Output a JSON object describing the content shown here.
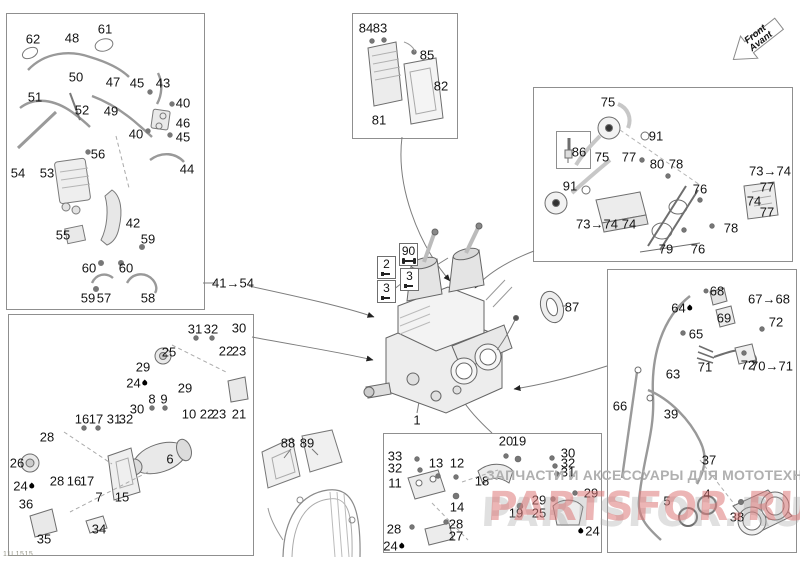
{
  "meta": {
    "doc_code": "11L1515"
  },
  "front_arrow": {
    "label_en": "Front",
    "label_fr": "Avant"
  },
  "watermark": {
    "text_ru": "ЗАПЧАСТИ И АКСЕССУАРЫ ДЛЯ МОТОТЕХНИКИ",
    "brand": "PARTSFOR.RU",
    "text_color": "#b0b0b0",
    "brand_color": "rgba(220,120,120,0.55)",
    "brand_shadow_color": "rgba(165,165,165,0.35)"
  },
  "boxes": [
    {
      "name": "hose-system",
      "x": 6,
      "y": 13,
      "w": 197,
      "h": 295
    },
    {
      "name": "engine-mount-starter",
      "x": 8,
      "y": 314,
      "w": 244,
      "h": 240
    },
    {
      "name": "electronic-module",
      "x": 352,
      "y": 13,
      "w": 104,
      "h": 124
    },
    {
      "name": "ignition-system",
      "x": 533,
      "y": 87,
      "w": 258,
      "h": 173
    },
    {
      "name": "engine-mount-rear",
      "x": 383,
      "y": 433,
      "w": 217,
      "h": 118
    },
    {
      "name": "oil-fuel-lines",
      "x": 607,
      "y": 269,
      "w": 188,
      "h": 282
    },
    {
      "name": "spark-plug-inner",
      "x": 556,
      "y": 131,
      "w": 33,
      "h": 36
    }
  ],
  "callouts": [
    {
      "text": "62",
      "x": 33,
      "y": 39
    },
    {
      "text": "48",
      "x": 72,
      "y": 38
    },
    {
      "text": "61",
      "x": 105,
      "y": 29
    },
    {
      "text": "50",
      "x": 76,
      "y": 77
    },
    {
      "text": "47",
      "x": 113,
      "y": 82
    },
    {
      "text": "45",
      "x": 137,
      "y": 83
    },
    {
      "text": "43",
      "x": 163,
      "y": 83
    },
    {
      "text": "51",
      "x": 35,
      "y": 97
    },
    {
      "text": "52",
      "x": 82,
      "y": 110
    },
    {
      "text": "49",
      "x": 111,
      "y": 111
    },
    {
      "text": "40",
      "x": 183,
      "y": 103
    },
    {
      "text": "46",
      "x": 183,
      "y": 123
    },
    {
      "text": "40",
      "x": 136,
      "y": 134
    },
    {
      "text": "45",
      "x": 183,
      "y": 137
    },
    {
      "text": "56",
      "x": 98,
      "y": 154
    },
    {
      "text": "44",
      "x": 187,
      "y": 169
    },
    {
      "text": "54",
      "x": 18,
      "y": 173
    },
    {
      "text": "53",
      "x": 47,
      "y": 173
    },
    {
      "text": "42",
      "x": 133,
      "y": 223
    },
    {
      "text": "55",
      "x": 63,
      "y": 235
    },
    {
      "text": "59",
      "x": 148,
      "y": 239
    },
    {
      "text": "60",
      "x": 89,
      "y": 268
    },
    {
      "text": "60",
      "x": 126,
      "y": 268
    },
    {
      "text": "59",
      "x": 88,
      "y": 298
    },
    {
      "text": "57",
      "x": 104,
      "y": 298
    },
    {
      "text": "58",
      "x": 148,
      "y": 298
    },
    {
      "text": "41→54",
      "x": 233,
      "y": 283
    },
    {
      "text": "31",
      "x": 195,
      "y": 329
    },
    {
      "text": "32",
      "x": 211,
      "y": 329
    },
    {
      "text": "30",
      "x": 239,
      "y": 328
    },
    {
      "text": "25",
      "x": 169,
      "y": 352
    },
    {
      "text": "22",
      "x": 226,
      "y": 351
    },
    {
      "text": "23",
      "x": 239,
      "y": 351
    },
    {
      "text": "29",
      "x": 143,
      "y": 367
    },
    {
      "text": "24",
      "x": 137,
      "y": 383,
      "droplet": "right"
    },
    {
      "text": "29",
      "x": 185,
      "y": 388
    },
    {
      "text": "8",
      "x": 152,
      "y": 399
    },
    {
      "text": "9",
      "x": 164,
      "y": 399
    },
    {
      "text": "30",
      "x": 137,
      "y": 409
    },
    {
      "text": "10",
      "x": 189,
      "y": 414
    },
    {
      "text": "22",
      "x": 207,
      "y": 414
    },
    {
      "text": "23",
      "x": 219,
      "y": 414
    },
    {
      "text": "21",
      "x": 239,
      "y": 414
    },
    {
      "text": "16",
      "x": 82,
      "y": 419
    },
    {
      "text": "17",
      "x": 96,
      "y": 419
    },
    {
      "text": "31",
      "x": 114,
      "y": 419
    },
    {
      "text": "32",
      "x": 126,
      "y": 419
    },
    {
      "text": "28",
      "x": 47,
      "y": 437
    },
    {
      "text": "26",
      "x": 17,
      "y": 463
    },
    {
      "text": "6",
      "x": 170,
      "y": 459
    },
    {
      "text": "28",
      "x": 57,
      "y": 481
    },
    {
      "text": "16",
      "x": 74,
      "y": 481
    },
    {
      "text": "17",
      "x": 87,
      "y": 481
    },
    {
      "text": "24",
      "x": 24,
      "y": 486,
      "droplet": "right"
    },
    {
      "text": "7",
      "x": 99,
      "y": 497
    },
    {
      "text": "15",
      "x": 122,
      "y": 497
    },
    {
      "text": "36",
      "x": 26,
      "y": 504
    },
    {
      "text": "34",
      "x": 99,
      "y": 529
    },
    {
      "text": "35",
      "x": 44,
      "y": 539
    },
    {
      "text": "84",
      "x": 366,
      "y": 28
    },
    {
      "text": "83",
      "x": 380,
      "y": 28
    },
    {
      "text": "85",
      "x": 427,
      "y": 55
    },
    {
      "text": "82",
      "x": 441,
      "y": 86
    },
    {
      "text": "81",
      "x": 379,
      "y": 120
    },
    {
      "text": "75",
      "x": 608,
      "y": 102
    },
    {
      "text": "91",
      "x": 656,
      "y": 136
    },
    {
      "text": "86",
      "x": 579,
      "y": 152
    },
    {
      "text": "75",
      "x": 602,
      "y": 157
    },
    {
      "text": "77",
      "x": 629,
      "y": 157
    },
    {
      "text": "80",
      "x": 657,
      "y": 164
    },
    {
      "text": "78",
      "x": 676,
      "y": 164
    },
    {
      "text": "73→74",
      "x": 770,
      "y": 171
    },
    {
      "text": "77",
      "x": 767,
      "y": 187
    },
    {
      "text": "76",
      "x": 700,
      "y": 189
    },
    {
      "text": "74",
      "x": 754,
      "y": 201
    },
    {
      "text": "77",
      "x": 767,
      "y": 212
    },
    {
      "text": "91",
      "x": 570,
      "y": 186
    },
    {
      "text": "73→74",
      "x": 597,
      "y": 224
    },
    {
      "text": "74",
      "x": 629,
      "y": 224
    },
    {
      "text": "78",
      "x": 731,
      "y": 228
    },
    {
      "text": "79",
      "x": 666,
      "y": 249
    },
    {
      "text": "76",
      "x": 698,
      "y": 249
    },
    {
      "text": "87",
      "x": 572,
      "y": 307
    },
    {
      "text": "1",
      "x": 417,
      "y": 420
    },
    {
      "text": "88",
      "x": 288,
      "y": 443
    },
    {
      "text": "89",
      "x": 307,
      "y": 443
    },
    {
      "text": "68",
      "x": 717,
      "y": 291
    },
    {
      "text": "67→68",
      "x": 769,
      "y": 299
    },
    {
      "text": "64",
      "x": 682,
      "y": 308,
      "droplet": "right"
    },
    {
      "text": "69",
      "x": 724,
      "y": 318
    },
    {
      "text": "72",
      "x": 776,
      "y": 322
    },
    {
      "text": "65",
      "x": 696,
      "y": 334
    },
    {
      "text": "71",
      "x": 705,
      "y": 367
    },
    {
      "text": "72",
      "x": 748,
      "y": 365
    },
    {
      "text": "70→71",
      "x": 772,
      "y": 366
    },
    {
      "text": "63",
      "x": 673,
      "y": 374
    },
    {
      "text": "66",
      "x": 620,
      "y": 406
    },
    {
      "text": "39",
      "x": 671,
      "y": 414
    },
    {
      "text": "37",
      "x": 709,
      "y": 460
    },
    {
      "text": "5",
      "x": 667,
      "y": 501
    },
    {
      "text": "4",
      "x": 707,
      "y": 494
    },
    {
      "text": "38",
      "x": 737,
      "y": 517
    },
    {
      "text": "33",
      "x": 395,
      "y": 456
    },
    {
      "text": "32",
      "x": 395,
      "y": 468
    },
    {
      "text": "11",
      "x": 395,
      "y": 483
    },
    {
      "text": "13",
      "x": 436,
      "y": 463
    },
    {
      "text": "12",
      "x": 457,
      "y": 463
    },
    {
      "text": "14",
      "x": 457,
      "y": 507
    },
    {
      "text": "18",
      "x": 482,
      "y": 481
    },
    {
      "text": "20",
      "x": 506,
      "y": 441
    },
    {
      "text": "19",
      "x": 519,
      "y": 441
    },
    {
      "text": "30",
      "x": 568,
      "y": 453
    },
    {
      "text": "32",
      "x": 568,
      "y": 463
    },
    {
      "text": "31",
      "x": 568,
      "y": 472
    },
    {
      "text": "29",
      "x": 591,
      "y": 493
    },
    {
      "text": "29",
      "x": 539,
      "y": 500
    },
    {
      "text": "19",
      "x": 516,
      "y": 513
    },
    {
      "text": "25",
      "x": 539,
      "y": 513
    },
    {
      "text": "24",
      "x": 589,
      "y": 531,
      "droplet": "left"
    },
    {
      "text": "28",
      "x": 456,
      "y": 524
    },
    {
      "text": "28",
      "x": 394,
      "y": 529
    },
    {
      "text": "27",
      "x": 456,
      "y": 536
    },
    {
      "text": "24",
      "x": 394,
      "y": 546,
      "droplet": "right"
    },
    {
      "text": "2",
      "x": 377,
      "y": 256,
      "boxed": true,
      "icon": "screw-icon"
    },
    {
      "text": "3",
      "x": 377,
      "y": 280,
      "boxed": true,
      "icon": "screw-icon"
    },
    {
      "text": "90",
      "x": 399,
      "y": 243,
      "boxed": true,
      "icon": "wrench-icon"
    },
    {
      "text": "3",
      "x": 400,
      "y": 268,
      "boxed": true,
      "icon": "screw-icon"
    }
  ]
}
